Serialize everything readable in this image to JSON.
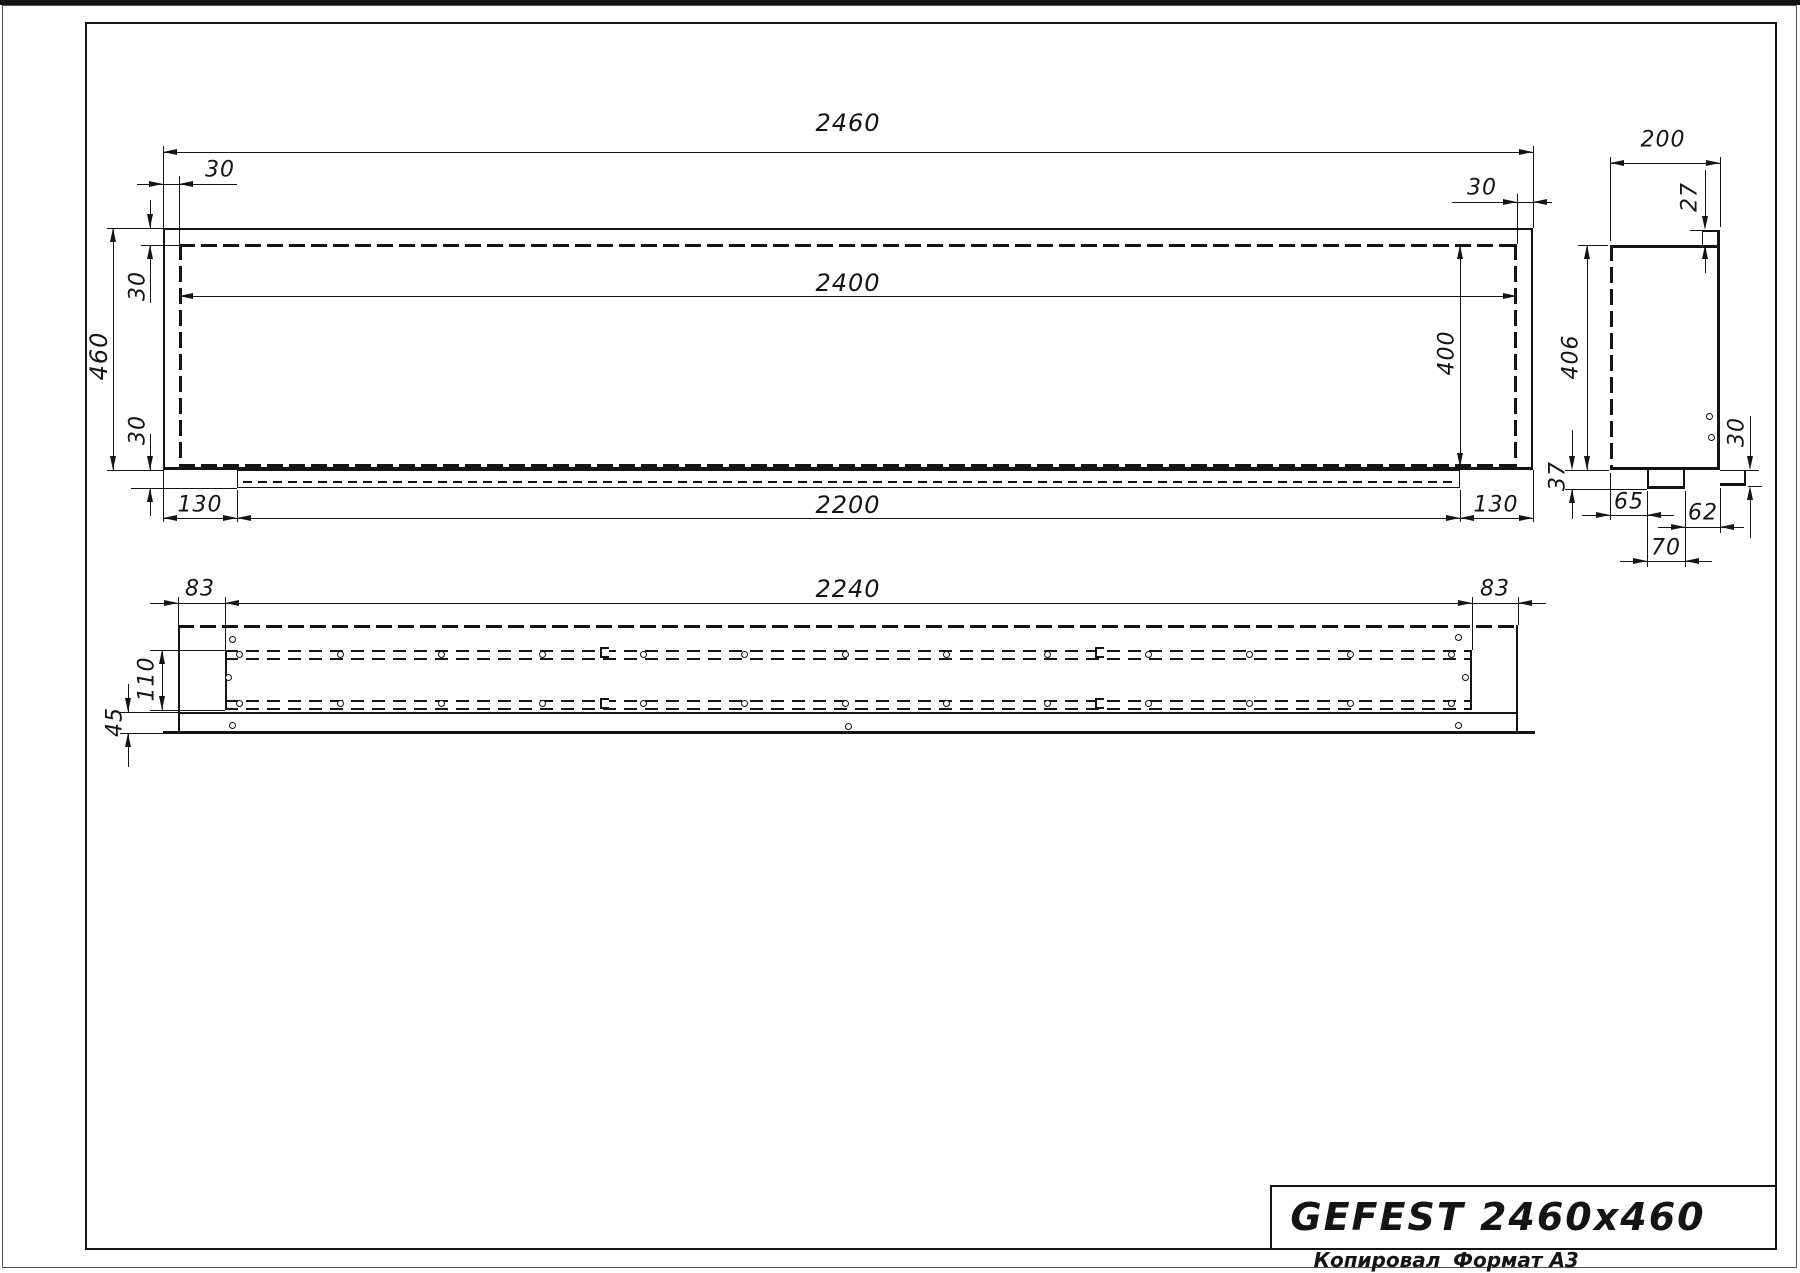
{
  "page": {
    "copied_label": "Копировал",
    "format_label": "Формат А3"
  },
  "title_block": {
    "title": "GEFEST 2460x460"
  },
  "front_view": {
    "dims": {
      "total_width": "2460",
      "inner_width": "2400",
      "top_frame_left": "30",
      "top_frame_right": "30",
      "height": "460",
      "left_band_top": "30",
      "left_band_bottom": "30",
      "ledge_left": "130",
      "ledge_length": "2200",
      "ledge_right": "130",
      "inner_height": "400"
    }
  },
  "side_view": {
    "dims": {
      "depth": "200",
      "lip": "27",
      "inner_height": "406",
      "bottom_step": "37",
      "notch_offset": "65",
      "notch_width": "70",
      "front_step": "62",
      "flange_height": "30"
    }
  },
  "bottom_view": {
    "dims": {
      "margin_left": "83",
      "slot_length": "2240",
      "margin_right": "83",
      "slot_width": "110",
      "flange_depth": "45"
    }
  },
  "line_color": "#141414"
}
